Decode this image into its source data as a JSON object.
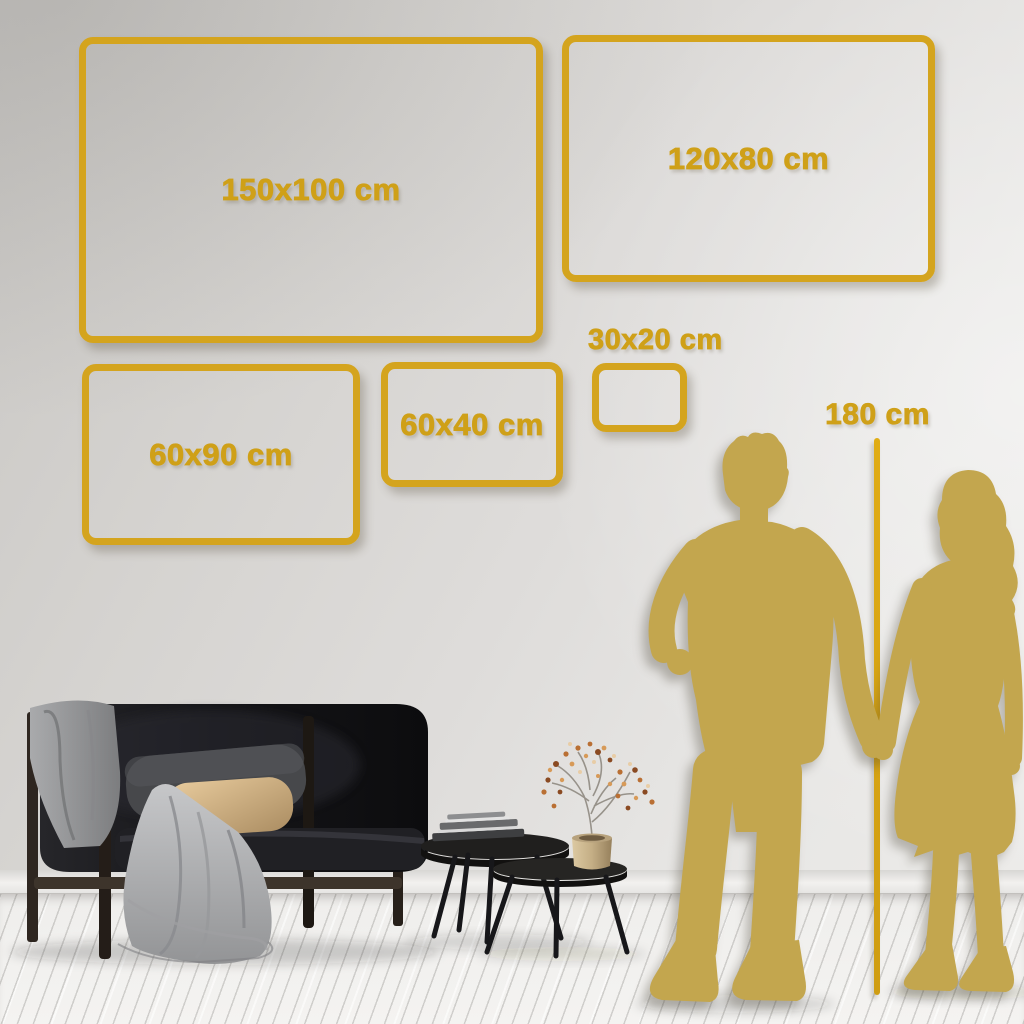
{
  "title_hint": "wall art size guide mockup",
  "frames": [
    {
      "id": "150x100",
      "label": "150x100 cm"
    },
    {
      "id": "120x80",
      "label": "120x80 cm"
    },
    {
      "id": "60x90",
      "label": "60x90 cm"
    },
    {
      "id": "60x40",
      "label": "60x40 cm"
    },
    {
      "id": "30x20",
      "label": "30x20 cm"
    }
  ],
  "height_reference": {
    "label": "180 cm"
  },
  "colors": {
    "frame_gold": "#d4a41e",
    "label_gold": "#cfa018",
    "silhouette_gold": "#c3a64e",
    "height_line_gold": "#d9a716",
    "wall_gray": "#d5d3d0",
    "floor_white": "#efeeec"
  }
}
